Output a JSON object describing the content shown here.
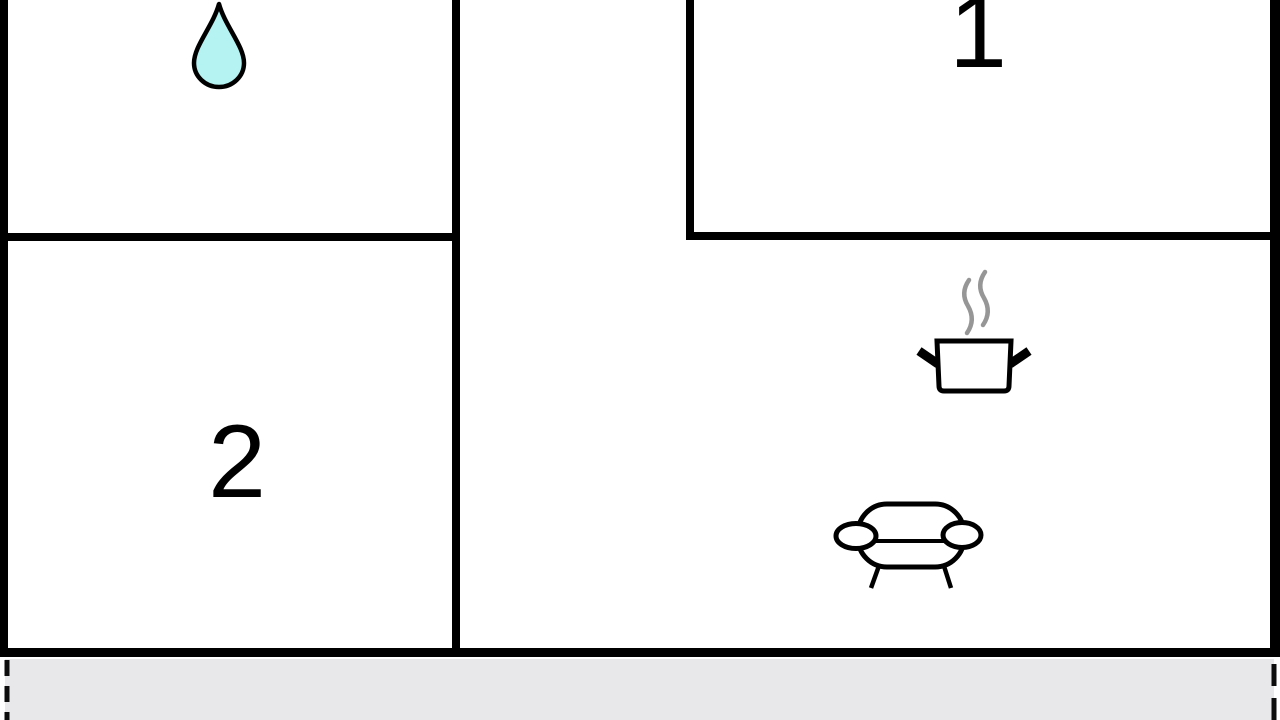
{
  "plan": {
    "type": "apartment-floor-plan",
    "rooms": {
      "room1": {
        "label": "1"
      },
      "room2": {
        "label": "2"
      },
      "bathroom": {
        "icon": "water-drop-icon"
      },
      "kitchen": {
        "icon": "cooking-pot-icon"
      },
      "living": {
        "icon": "sofa-icon"
      },
      "terrace": {
        "icon": ""
      }
    }
  },
  "icons": {
    "water_drop": "water-drop-icon",
    "steam": "steam-icon",
    "cooking_pot": "cooking-pot-icon",
    "sofa": "sofa-icon"
  },
  "colors": {
    "wall": "#000000",
    "room_fill": "#ffffff",
    "water_drop_fill": "#b5f2f2",
    "steam": "#969696",
    "terrace_fill": "#e8e8ea",
    "dashed_line": "#0d0d0d"
  }
}
